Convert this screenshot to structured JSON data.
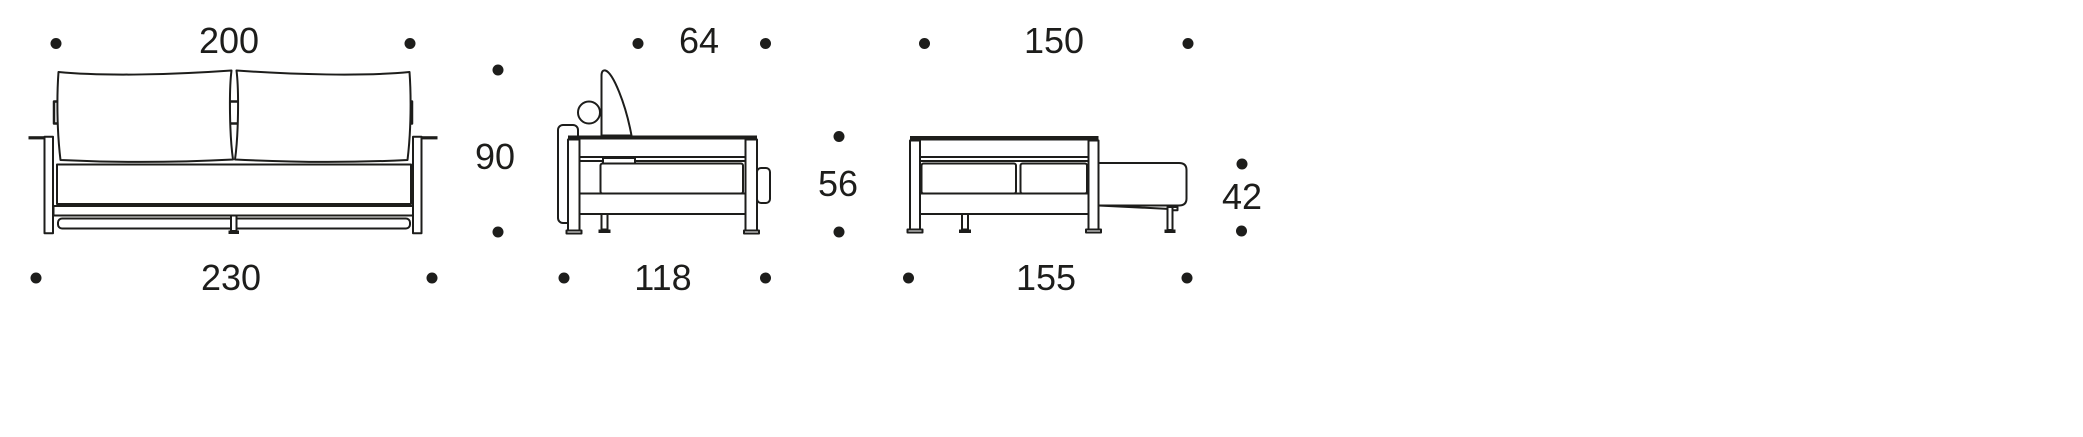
{
  "diagram": {
    "background": "#ffffff",
    "line_color": "#1d1d1b",
    "views": [
      {
        "id": "sofa-front-view",
        "top_dimension": "200",
        "bottom_dimension": "230",
        "height_dimension": "90"
      },
      {
        "id": "sofa-side-view-closed",
        "top_dimension": "64",
        "bottom_dimension": "118",
        "height_dimension": "56"
      },
      {
        "id": "sofa-side-view-extended",
        "top_dimension": "150",
        "bottom_dimension": "155",
        "height_dimension": "42"
      }
    ]
  }
}
